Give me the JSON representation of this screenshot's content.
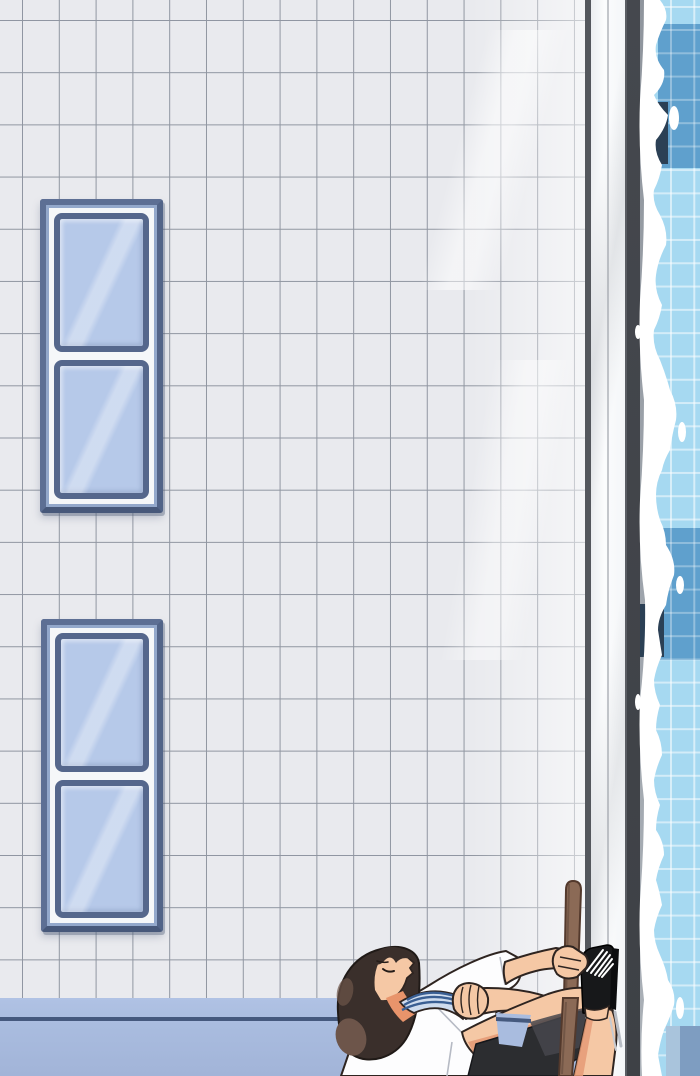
{
  "canvas": {
    "width": 700,
    "height": 1076
  },
  "scene": {
    "type": "webtoon comic panel, no text",
    "setting": "indoor swimming pool seen sideways: white tiled wall, pool deck edge and foamy lane water on the right",
    "wall": {
      "description": "white rectangular tiles with gray grout",
      "tile_width_px": 37,
      "tile_height_px": 52
    },
    "windows": [
      {
        "name": "upper window",
        "panes": 2,
        "glass": "light periwinkle blue"
      },
      {
        "name": "lower window",
        "panes": 2,
        "glass": "light periwinkle blue"
      }
    ],
    "floor_band": {
      "description": "blue-lavender baseboard band with dark navy accent line"
    },
    "pool": {
      "deck": "white coping strip with groove line",
      "edge_wall": "dark charcoal strip",
      "water": "light blue with underwater tile grid, white foam along the edge",
      "lane_markings": [
        "medium blue patch top",
        "navy end-marker top",
        "medium blue patch middle",
        "navy end-marker middle",
        "blue-gray patch bottom"
      ]
    },
    "character": {
      "description": "boy leaning far back, arms stretched to his raised foot pressed on the pool edge",
      "hair": "dark brown with lighter brown sheen",
      "shirt": "white tee",
      "neck_accessory": "rolled towel with navy stripes",
      "shorts": "black",
      "footwear": "black slide sandal with white tread marks",
      "prop": "wooden deck-brush pole, held upright"
    }
  },
  "palette": {
    "wall_tile": "#e9eaee",
    "wall_grout": "#9096a1",
    "floor_band": "#a9bcdf",
    "floor_line": "#45597e",
    "corner_line": "#54575d",
    "pool_wall": "#3e4146",
    "water_light": "#a6d9f1",
    "water_mid": "#5fa0cd",
    "water_navy": "#2b4055",
    "water_bottom": "#7e9dc1",
    "window_frame": "#5d6f94",
    "window_bevel": "#93a8cb",
    "window_white": "#f5f7f9",
    "window_pane_frame": "#55678c",
    "window_glass": "#b6c9e9",
    "skin": "#f5c8a5",
    "skin_shadow": "#e59a76",
    "neck_shadow": "#e8946b",
    "hair": "#3a2f2b",
    "hair_light": "#6d554a",
    "hair_outline": "#201a17",
    "outline": "#2e2420",
    "shirt": "#fdfdfe",
    "towel": "#cfdcee",
    "towel_stripe": "#3a5f93",
    "shorts": "#2c2d30",
    "shorts_light": "#46474c",
    "sandal": "#17181a",
    "pole": "#8b6a56",
    "pole_outline": "#53392c"
  }
}
